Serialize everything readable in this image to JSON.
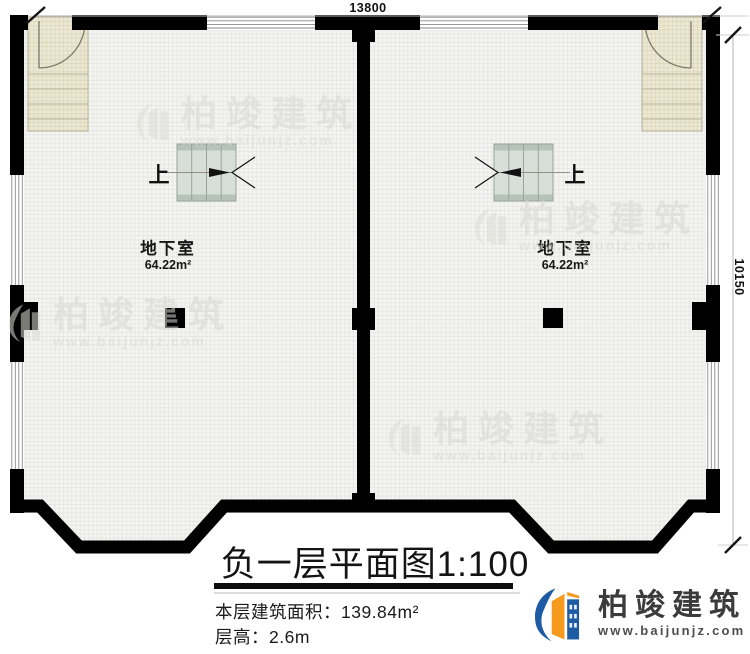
{
  "dimensions": {
    "top": "13800",
    "right": "10150"
  },
  "rooms": {
    "left": {
      "name": "地下室",
      "area": "64.22m²",
      "stair": "上"
    },
    "right": {
      "name": "地下室",
      "area": "64.22m²",
      "stair": "上"
    }
  },
  "title_block": {
    "title": "负一层平面图1:100",
    "area_label": "本层建筑面积：139.84m²",
    "floor_height_label": "层高：2.6m"
  },
  "logo": {
    "brand": "柏竣建筑",
    "url": "www.baijunjz.com"
  },
  "watermark": {
    "brand": "柏竣建筑",
    "url": "www.baijunjz.com"
  },
  "colors": {
    "wall": "#000000",
    "floor": "#f4f4f2",
    "stair_beige": "#ece8d4",
    "stair_green": "#d8dfd9",
    "logo_blue": "#1d5ba4",
    "logo_orange": "#f59a1d",
    "watermark": "#d7d7d4"
  }
}
